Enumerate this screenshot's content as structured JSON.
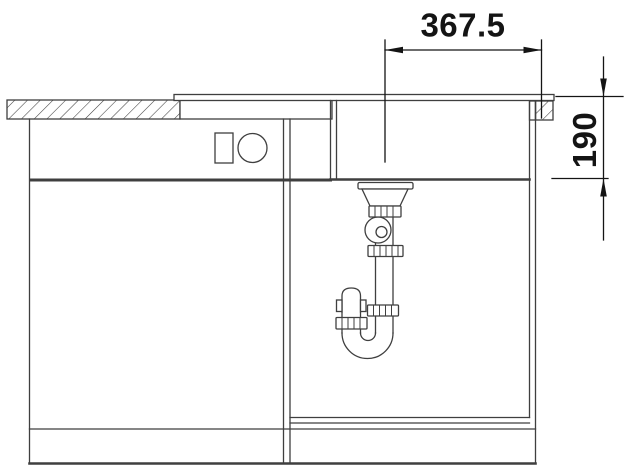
{
  "drawing": {
    "kind": "sink-installation-section",
    "dimensions": {
      "drain_offset": "367.5",
      "bowl_depth": "190"
    },
    "colors": {
      "background": "#ffffff",
      "line": "#3f3f3f",
      "dimension": "#141414"
    }
  }
}
